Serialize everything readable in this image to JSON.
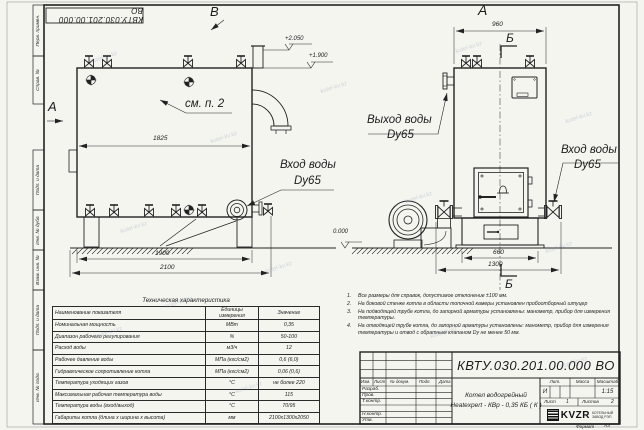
{
  "watermark": "kotel-kv.kz",
  "frame": {
    "left_labels": [
      "Перв. примен.",
      "Справ. №",
      "Подп. и дата",
      "Инв. № дубл.",
      "Взам. инв. №",
      "Подп. и дата",
      "Инв. № подл."
    ],
    "format_label": "Формат",
    "format_value": "А3"
  },
  "views": {
    "side": {
      "label_top": "В",
      "label_left": "А",
      "callout": "см. п. 2",
      "dim_inner": "1825",
      "dim_legs": "1900",
      "dim_total": "2100",
      "elev1": "+2.050",
      "elev2": "+1.900",
      "elev_zero": "0.000",
      "inlet1": "Вход воды",
      "inlet2": "Dy65"
    },
    "front": {
      "label_top": "А",
      "section": "Б",
      "dim_top": "960",
      "dim_base": "660",
      "dim_total": "1300",
      "outlet1": "Выход воды",
      "outlet2": "Dy65",
      "inlet1": "Вход воды",
      "inlet2": "Dy65"
    }
  },
  "notes": {
    "items": [
      {
        "num": "1.",
        "text": "Все размеры для справок, допустимое отклонение ±100 мм."
      },
      {
        "num": "2.",
        "text": "На боковой стенке котла в области топочной камеры установлен пробоотборный штуцер"
      },
      {
        "num": "3.",
        "text": "На подводящей трубе котла, до запорной арматуры установлены: манометр, прибор для измерения температуры."
      },
      {
        "num": "4.",
        "text": "На отводящей трубе котла, до запорной арматуры установлены: манометр, прибор для измерения температуры и отвод с обратным клапаном Dу не менее 50 мм."
      }
    ]
  },
  "spec_table": {
    "title": "Техническая характеристика",
    "col1": "Наименование показателя",
    "col2a": "Единицы",
    "col2b": "измерения",
    "col3": "Значение",
    "rows": [
      {
        "name": "Номинальная мощность",
        "unit": "МВт",
        "value": "0,35"
      },
      {
        "name": "Диапазон рабочего регулирования",
        "unit": "%",
        "value": "50-100"
      },
      {
        "name": "Расход воды",
        "unit": "м3/ч",
        "value": "12"
      },
      {
        "name": "Рабочее давление воды",
        "unit": "МПа (кгс/см2)",
        "value": "0,6 (6,0)"
      },
      {
        "name": "Гидравлическое сопротивление котла",
        "unit": "МПа (кгс/см2)",
        "value": "0,06 (0,6)"
      },
      {
        "name": "Температура уходящих газов",
        "unit": "°С",
        "value": "не более 220"
      },
      {
        "name": "Максимальная рабочая температура воды",
        "unit": "°С",
        "value": "115"
      },
      {
        "name": "Температура воды (вход/выход)",
        "unit": "°С",
        "value": "70/95"
      },
      {
        "name": "Габариты котла (длина х ширина х высота)",
        "unit": "мм",
        "value": "2100х1300х2050"
      }
    ]
  },
  "title_block": {
    "doc_number": "КВТУ.030.201.00.000 ВО",
    "name_line1": "Котел водогрейный",
    "name_line2": "Heatexpert - КВр - 0,35 КБ ( К )",
    "hdr": [
      "Изм.",
      "Лист",
      "№ докум.",
      "Подп.",
      "Дата"
    ],
    "rows": [
      "Разраб.",
      "Пров.",
      "Т.контр.",
      "",
      "Н.контр.",
      "Утв."
    ],
    "lit_label": "Лит.",
    "mass_label": "Масса",
    "scale_label": "Масштаб",
    "lit_value": "И",
    "mass_value": "",
    "scale_value": "1:15",
    "sheet_label": "Лист",
    "sheet_value": "1",
    "sheets_label": "Листов",
    "sheets_value": "2",
    "logo_text": "KVZR",
    "logo_sub1": "КОТЕЛЬНЫЙ",
    "logo_sub2": "ЗАВОД РЭП"
  }
}
